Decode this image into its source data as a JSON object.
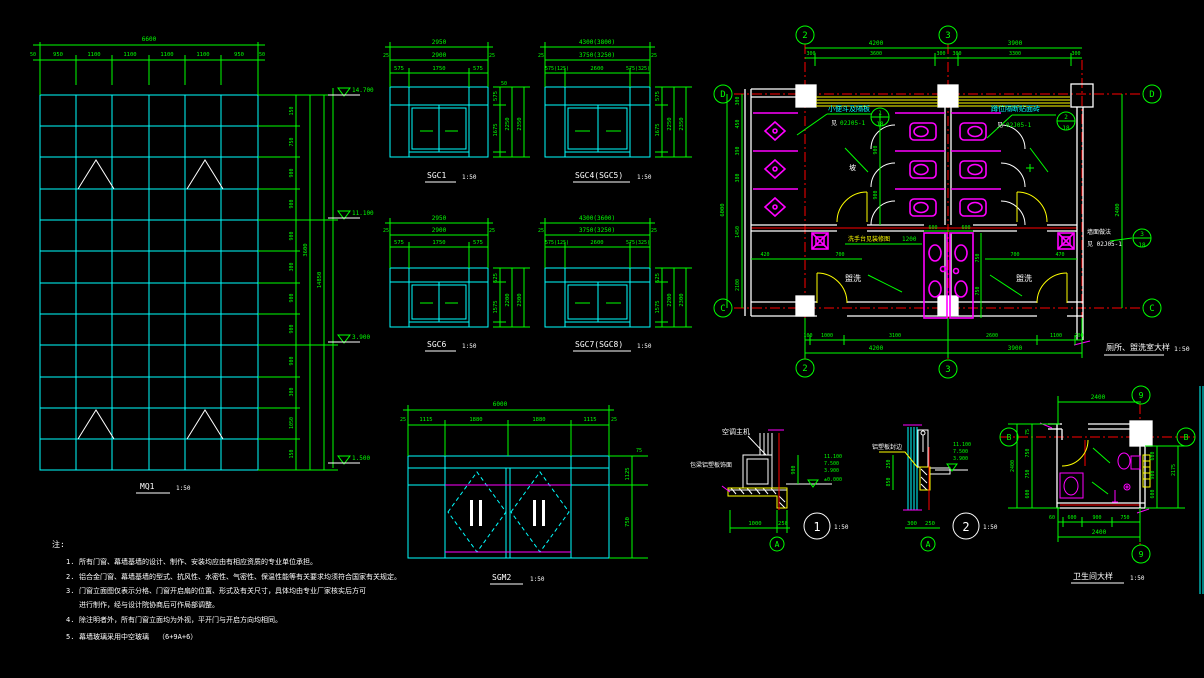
{
  "mq1": {
    "title": "MQ1",
    "scale": "1:50",
    "top_total": "6600",
    "top_end_l": "50",
    "top_end_r": "50",
    "top_segs": [
      "950",
      "1100",
      "1100",
      "1100",
      "1100",
      "950"
    ],
    "side_segs": [
      "150",
      "750",
      "900",
      "900",
      "900",
      "300",
      "900",
      "900",
      "900",
      "300",
      "1050",
      "150"
    ],
    "side_total_1": "3600",
    "side_total_2": "14850",
    "levels": [
      "14.700",
      "11.100",
      "3.900",
      "1.500"
    ]
  },
  "windows": {
    "sgc1": {
      "label": "SGC1",
      "scale": "1:50",
      "total": "2950",
      "inner": "2900",
      "end": "25",
      "segs": [
        "575",
        "1750",
        "575"
      ],
      "vsegs": [
        "575",
        "1675"
      ],
      "vmid": "2250",
      "vtotal": "2350",
      "vend": "50"
    },
    "sgc45": {
      "label": "SGC4(SGC5)",
      "scale": "1:50",
      "total": "4300(3800)",
      "inner": "3750(3250)",
      "end": "25",
      "segs": [
        "575(125)",
        "2600",
        "575(325)"
      ],
      "vsegs": [
        "575",
        "1675"
      ],
      "vmid": "2250",
      "vtotal": "2350",
      "vend": "50"
    },
    "sgc6": {
      "label": "SGC6",
      "scale": "1:50",
      "total": "2950",
      "inner": "2900",
      "end": "25",
      "segs": [
        "575",
        "1750",
        "575"
      ],
      "vsegs": [
        "625",
        "1575"
      ],
      "vmid": "2200",
      "vtotal": "2300",
      "vend": "50"
    },
    "sgc78": {
      "label": "SGC7(SGC8)",
      "scale": "1:50",
      "total": "4300(3600)",
      "inner": "3750(3250)",
      "end": "25",
      "segs": [
        "575(125)",
        "2600",
        "575(325)"
      ],
      "vsegs": [
        "625",
        "1575"
      ],
      "vmid": "2200",
      "vtotal": "2300",
      "vend": "50"
    },
    "sgm2": {
      "label": "SGM2",
      "scale": "1:50",
      "total": "6000",
      "end": "25",
      "segs": [
        "1115",
        "1880",
        "1880",
        "1115"
      ],
      "vtop": "75",
      "vsegs": [
        "1125",
        "750"
      ]
    }
  },
  "plan": {
    "title": "厕所、盥洗室大样",
    "scale": "1:50",
    "axes": {
      "a2": "2",
      "a3": "3",
      "ad": "D",
      "ac": "C"
    },
    "top_totals": [
      "4200",
      "3900"
    ],
    "top_segs": [
      "300",
      "3600",
      "300",
      "300",
      "3300",
      "300"
    ],
    "bot_segs": [
      "100",
      "1000",
      "3100",
      "2600",
      "1100",
      "200"
    ],
    "bot_totals": [
      "4200",
      "3900"
    ],
    "left_segs": [
      "300",
      "450",
      "390",
      "380",
      "1450",
      "2100"
    ],
    "left_total": "6000",
    "right_dims": [
      "2400",
      "6000"
    ],
    "aisle_segs": [
      "900",
      "900"
    ],
    "room_dims_l": [
      "420",
      "700"
    ],
    "room_dims_r": [
      "700",
      "470"
    ],
    "basin_segs": [
      "600",
      "600"
    ],
    "basin_side": [
      "750",
      "750"
    ],
    "basin_dim": "1200",
    "label_urinal": "小便斗及隔板",
    "label_stall": "蹲位隔断贴面砖",
    "label_basin": "洗手台见装修图",
    "ref_see": "见",
    "ref": "02J05-1",
    "bubble1": {
      "t": "1",
      "b": "18"
    },
    "bubble2": {
      "t": "2",
      "b": "18"
    },
    "bubble3": {
      "t": "3",
      "b": "18"
    },
    "wall_note1": "墙面做法",
    "wall_note2": "见 02J05-1",
    "room_left": "盥洗",
    "room_right": "盥洗",
    "slope_char": "坡"
  },
  "det1": {
    "num": "1",
    "scale": "1:50",
    "axis": "A",
    "label": "空调主机",
    "label2": "包梁铝塑板饰面",
    "levels": [
      "11.100",
      "7.500",
      "3.900"
    ],
    "level_zero": "±0.000",
    "v_dim": "900",
    "b_segs": [
      "1000",
      "250"
    ]
  },
  "det2": {
    "num": "2",
    "scale": "1:50",
    "axis": "A",
    "label": "铝塑板封边",
    "levels": [
      "11.100",
      "7.500",
      "3.900"
    ],
    "v_segs": [
      "250",
      "850"
    ],
    "b_segs": [
      "300",
      "250"
    ]
  },
  "wc": {
    "title": "卫生间大样",
    "scale": "1:50",
    "axis_9": "9",
    "axis_b": "B",
    "top_total": "2400",
    "left_segs": [
      "75",
      "750",
      "750",
      "600"
    ],
    "left_total": "2400",
    "right_segs": [
      "600",
      "900",
      "600"
    ],
    "right_total": "2175",
    "bot_segs": [
      "60",
      "600",
      "900",
      "750"
    ],
    "bot_total": "2400"
  },
  "notes": {
    "head": "注:",
    "items": [
      {
        "num": "1.",
        "text": "所有门窗、幕墙基墙的设计、制作、安装均应由有相应资质的专业单位承担。"
      },
      {
        "num": "2.",
        "text": "铝合金门窗、幕墙基墙的型式、抗风性、水密性、气密性、保温性能等有关要求均须符合国家有关规定。"
      },
      {
        "num": "3.",
        "text": "门窗立面图仅表示分格、门窗开启扇的位置、形式及有关尺寸，具体均由专业厂家核实后方可"
      },
      {
        "num": "",
        "text": "进行制作，经与设计院协商后可作局部调整。"
      },
      {
        "num": "4.",
        "text": "除注明者外，所有门窗立面均为外视，平开门与开启方向均相同。"
      },
      {
        "num": "5.",
        "text": "幕墙玻璃采用中空玻璃"
      }
    ],
    "glass": "（6+9A+6）"
  }
}
